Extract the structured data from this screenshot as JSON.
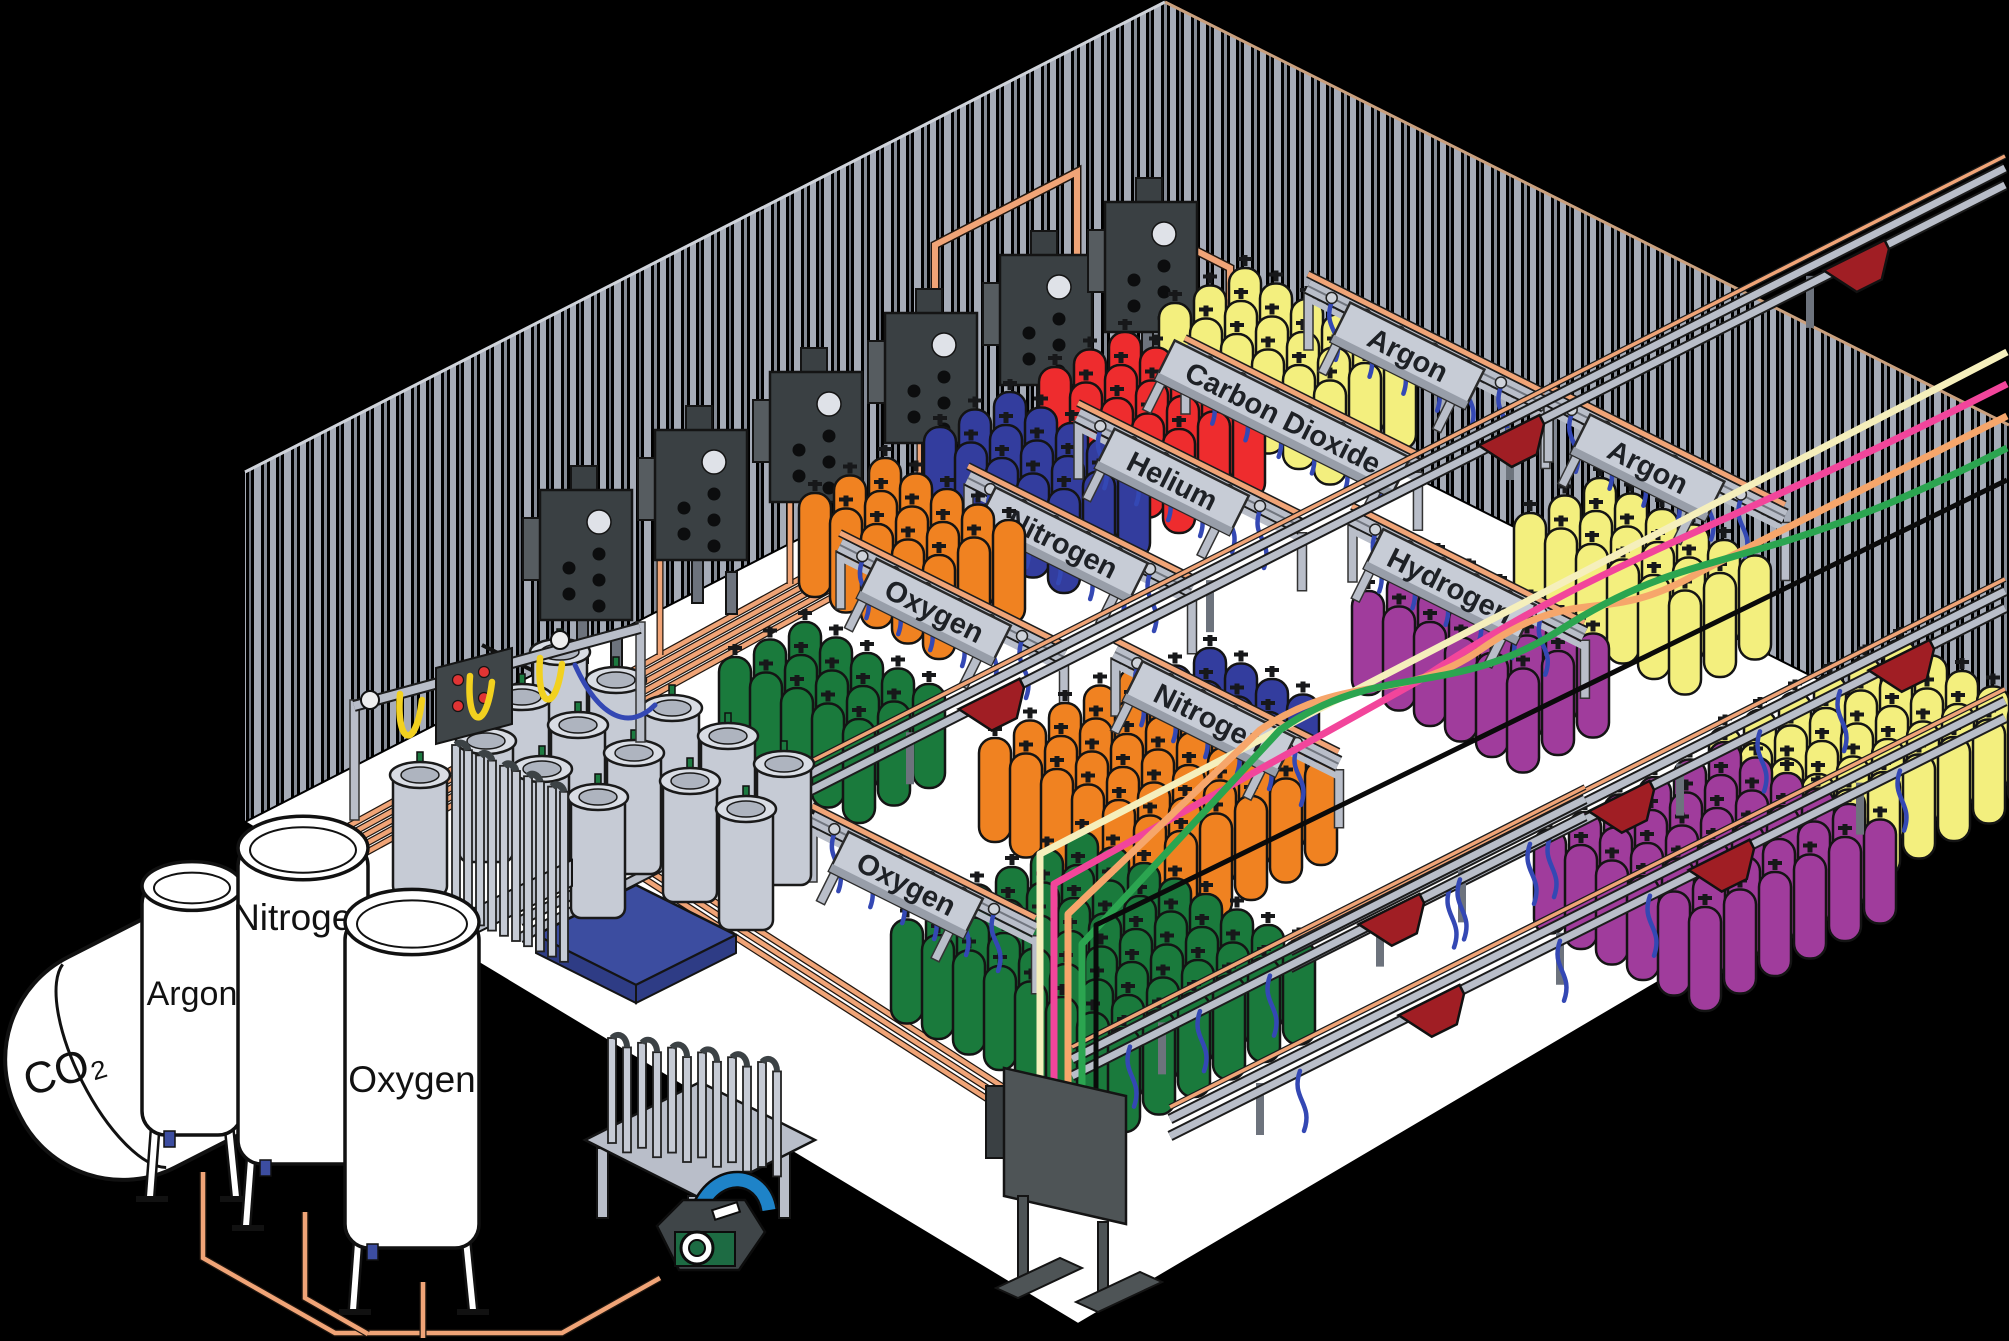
{
  "scene": {
    "description": "Isometric cutaway illustration of an industrial gas cylinder filling plant"
  },
  "stations": [
    {
      "label": "Oxygen"
    },
    {
      "label": "Nitrogen"
    },
    {
      "label": "Helium"
    },
    {
      "label": "Carbon Dioxide"
    },
    {
      "label": "Argon"
    },
    {
      "label": "Hydrogen"
    },
    {
      "label": "Argon"
    },
    {
      "label": "Nitrogen"
    },
    {
      "label": "Oxygen"
    }
  ],
  "tanks": [
    {
      "label": "CO₂"
    },
    {
      "label": "Argon"
    },
    {
      "label": "Nitrogen"
    },
    {
      "label": "Oxygen"
    }
  ],
  "cylinder_groups": [
    {
      "id": "carbon-dioxide-yellow",
      "color": "yellow",
      "count": 18
    },
    {
      "id": "helium-red",
      "color": "red",
      "count": 15
    },
    {
      "id": "nitrogen-navy-upper",
      "color": "navy",
      "count": 15
    },
    {
      "id": "nitrogen-navy-center",
      "color": "navy",
      "count": 8
    },
    {
      "id": "oxygen-orange-upper",
      "color": "orange",
      "count": 15
    },
    {
      "id": "argon-yellow-right",
      "color": "yellow",
      "count": 18
    },
    {
      "id": "hydrogen-purple",
      "color": "purple",
      "count": 18
    },
    {
      "id": "yellow-far-right",
      "color": "yellow",
      "count": 30
    },
    {
      "id": "oxygen-green-upper",
      "color": "green",
      "count": 15
    },
    {
      "id": "nitrogen-orange-big",
      "color": "orange",
      "count": 35
    },
    {
      "id": "purple-big",
      "color": "purple",
      "count": 36
    },
    {
      "id": "green-big",
      "color": "green",
      "count": 48
    }
  ],
  "colors": {
    "cylinders": {
      "green": "#1a7a3c",
      "orange": "#f08221",
      "navy": "#333d9e",
      "red": "#ee2c2e",
      "yellow": "#f3ef7e",
      "purple": "#a03c9c",
      "silver": "#c6cbd5"
    },
    "pipes": {
      "copper": "#f0a477",
      "cream": "#f5efbc",
      "pink": "#f2459b",
      "salmon": "#f6a66b",
      "green": "#2ba550",
      "black": "#0a0a0a"
    },
    "structure": {
      "wallStripe": "#a6acb8",
      "wallStripeDim": "#848a95",
      "floor": "#ffffff",
      "rail": "#b9bec9",
      "banner": "#c7ccd6",
      "panel": "#3a4043",
      "cart": "#a01e24",
      "hoseBlue": "#3448b4",
      "hoseYellow": "#f2d11f",
      "palletBlue": "#3c4da0",
      "pumpGreen": "#1d6b43",
      "pumpBlue": "#1e83c8",
      "buttonRed": "#e03434"
    }
  }
}
